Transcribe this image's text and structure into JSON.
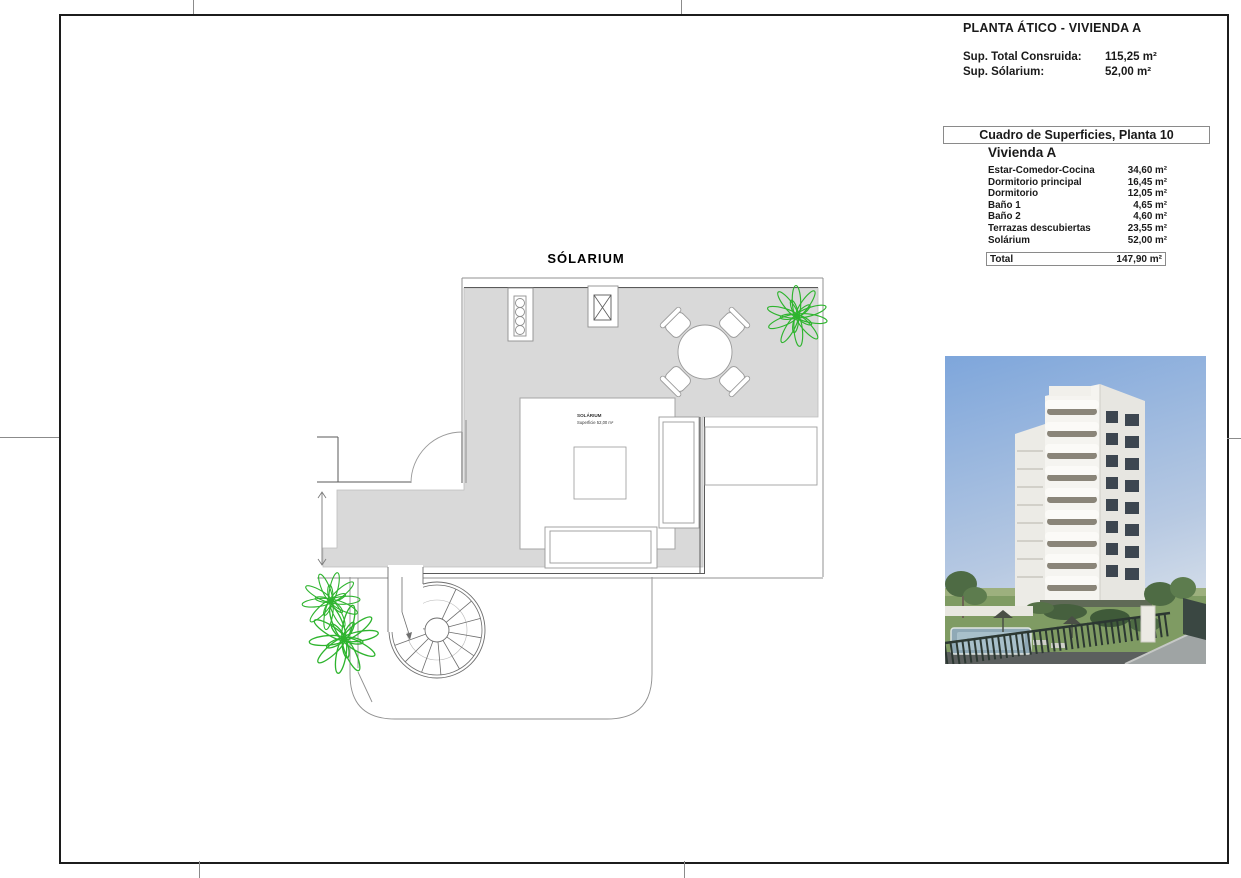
{
  "sheet": {
    "title": "PLANTA ÁTICO - VIVIENDA A",
    "summary": [
      {
        "label": "Sup. Total Consruida:",
        "value": "115,25 m²"
      },
      {
        "label": "Sup. Sólarium:",
        "value": "52,00 m²"
      }
    ]
  },
  "surfaces": {
    "box_title": "Cuadro de Superficies, Planta 10",
    "unit": "Vivienda A",
    "rows": [
      {
        "label": "Estar-Comedor-Cocina",
        "value": "34,60 m²"
      },
      {
        "label": "Dormitorio principal",
        "value": "16,45 m²"
      },
      {
        "label": "Dormitorio",
        "value": "12,05 m²"
      },
      {
        "label": "Baño 1",
        "value": "4,65 m²"
      },
      {
        "label": "Baño 2",
        "value": "4,60 m²"
      },
      {
        "label": "Terrazas descubiertas",
        "value": "23,55 m²"
      },
      {
        "label": "Solárium",
        "value": "52,00 m²"
      }
    ],
    "total": {
      "label": "Total",
      "value": "147,90 m²"
    }
  },
  "plan": {
    "title": "SÓLARIUM",
    "room_label": "SOLÁRIUM",
    "room_sublabel": "Superficie 52,00 m²"
  },
  "colors": {
    "terrace_gray": "#d9d9d9",
    "plant_green": "#2eb42e",
    "sky_blue": "#84a9dc",
    "frame_black": "#1c1c1c"
  }
}
